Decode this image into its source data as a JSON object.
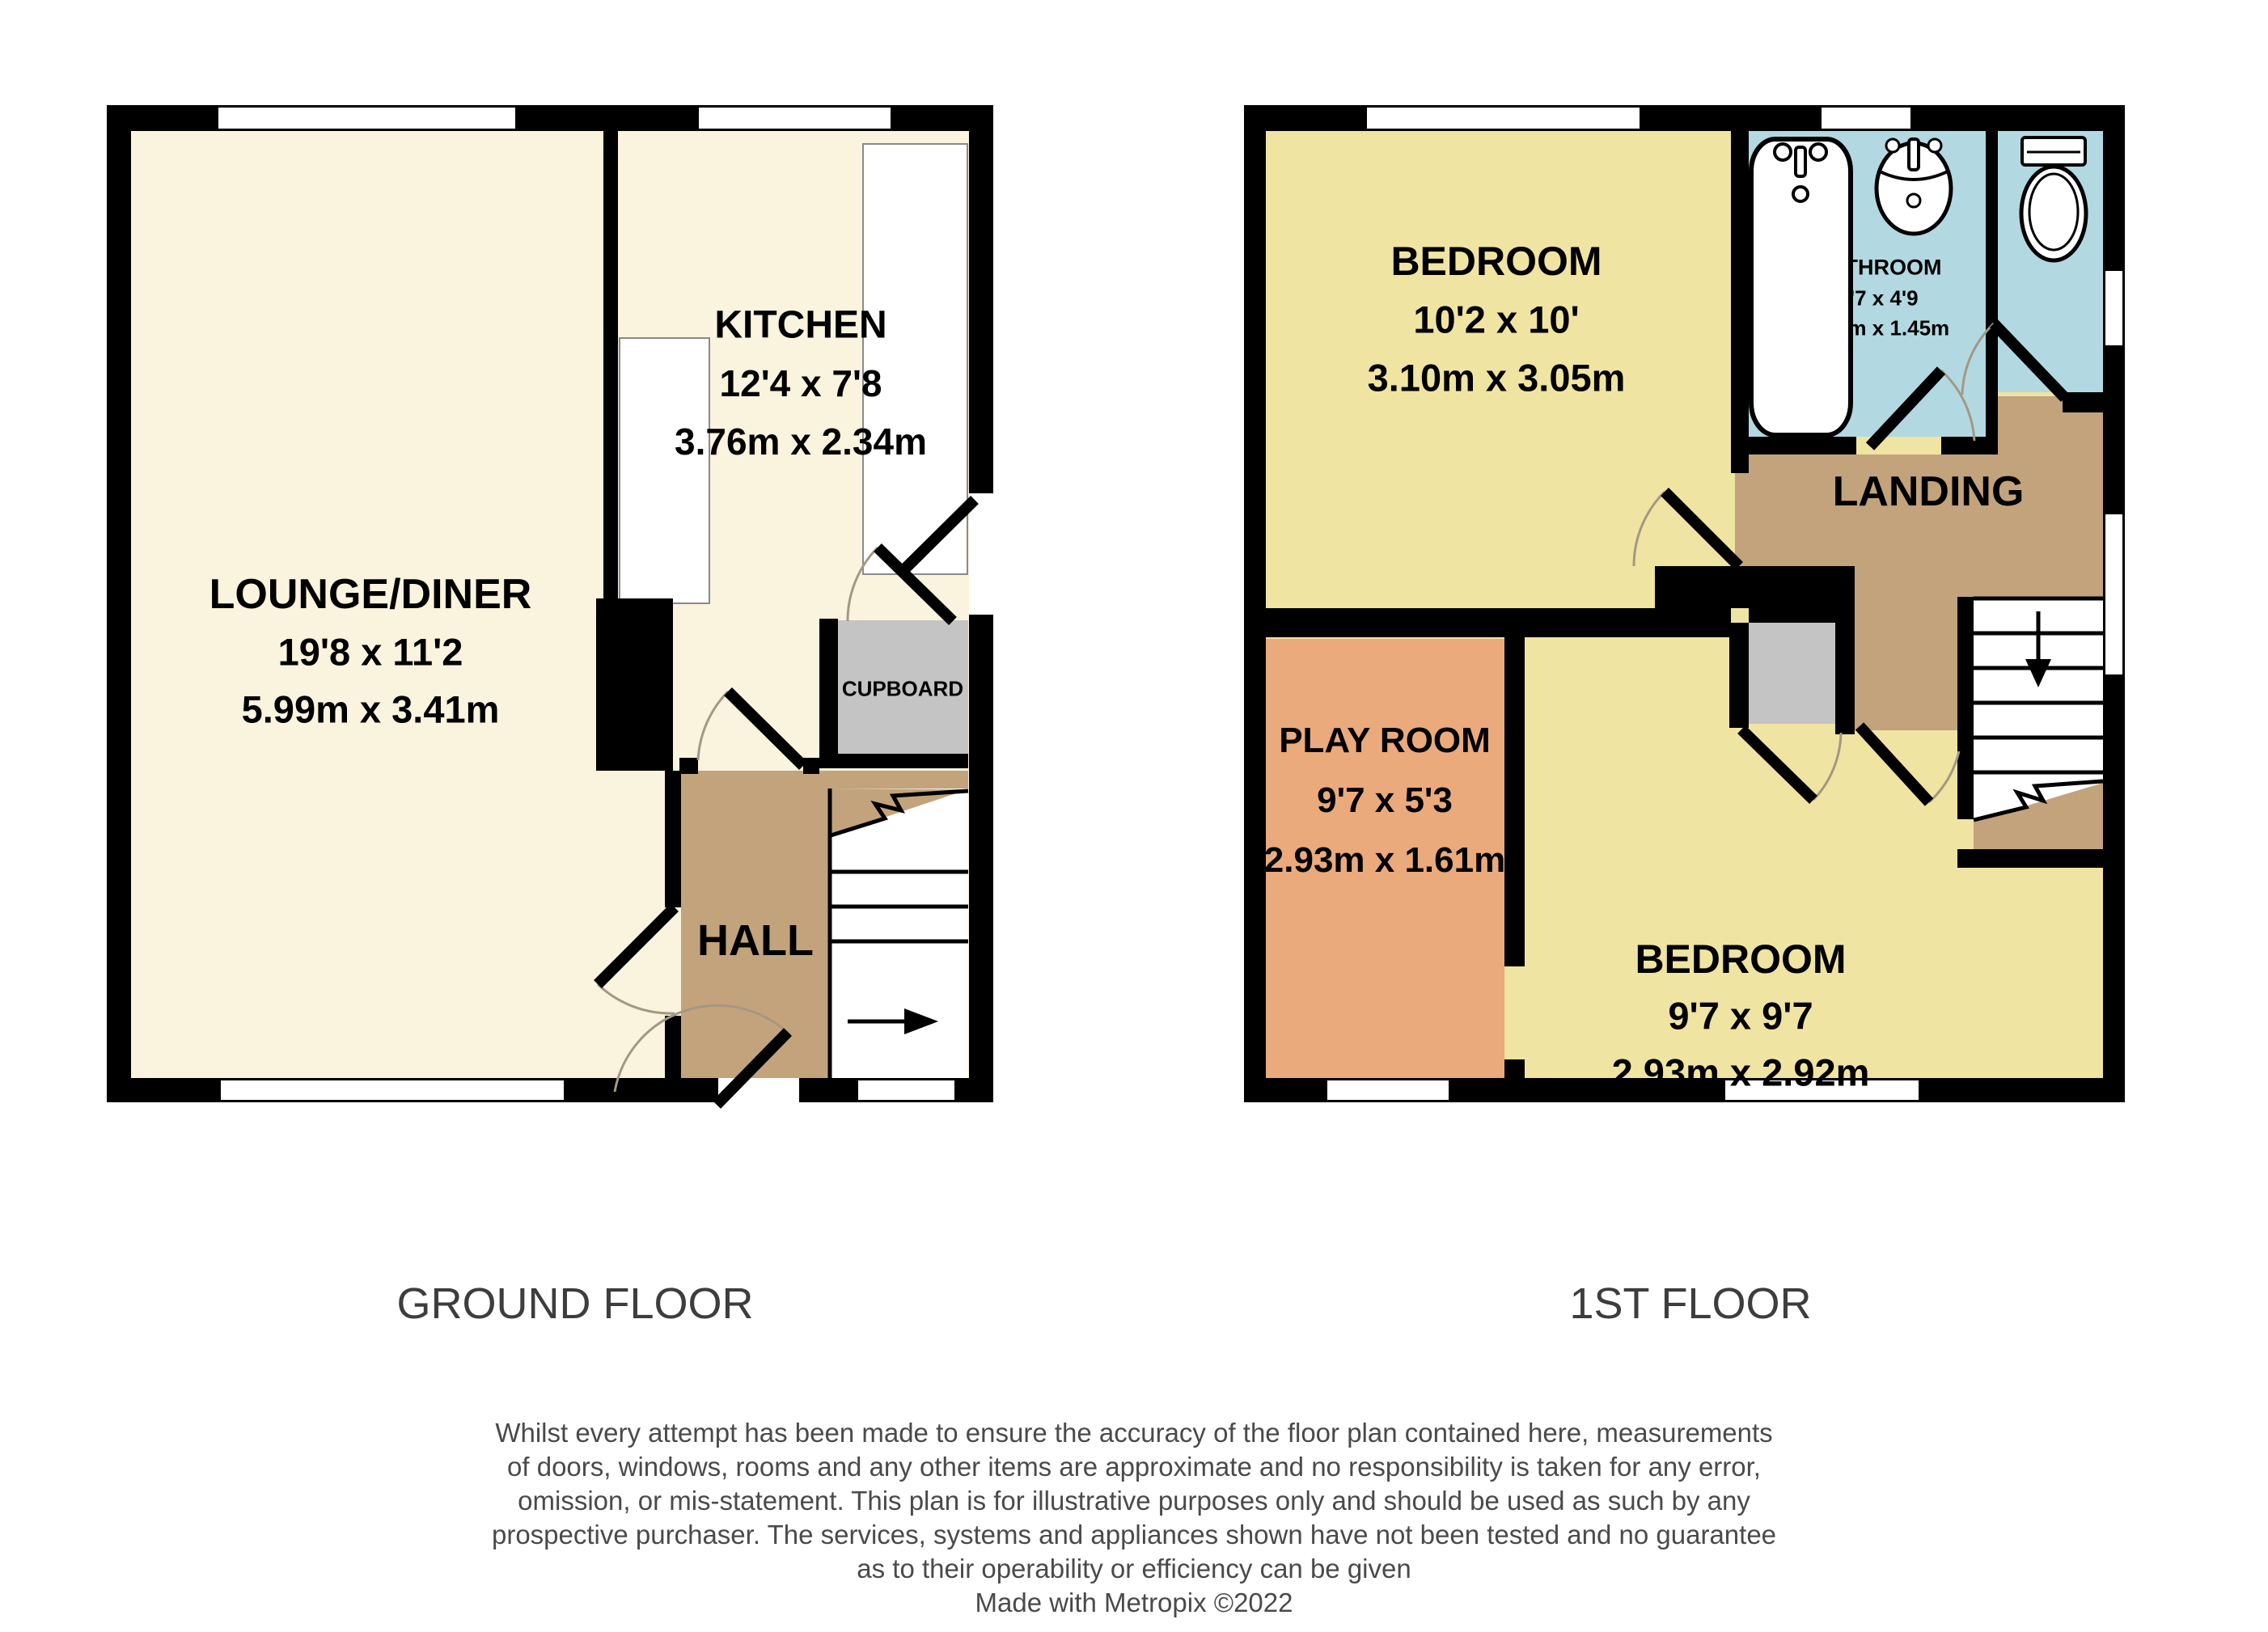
{
  "colors": {
    "wall": "#000000",
    "window": "#ffffff",
    "cream": "#FAF3DD",
    "tan": "#C3A37B",
    "yellow": "#EFE4A1",
    "orange": "#EAAA7C",
    "blue": "#B2D9E1",
    "gray": "#C4C4C4",
    "label": "#000000",
    "floor_label": "#3d3d3d",
    "disclaimer": "#4a4a4a",
    "arc": "#A39883"
  },
  "ground_floor": {
    "label": "GROUND FLOOR",
    "lounge": {
      "name": "LOUNGE/DINER",
      "imperial": "19'8 x 11'2",
      "metric": "5.99m x 3.41m"
    },
    "kitchen": {
      "name": "KITCHEN",
      "imperial": "12'4 x 7'8",
      "metric": "3.76m x 2.34m"
    },
    "hall": {
      "name": "HALL"
    },
    "cupboard": {
      "name": "CUPBOARD"
    }
  },
  "first_floor": {
    "label": "1ST FLOOR",
    "bedroom1": {
      "name": "BEDROOM",
      "imperial": "10'2 x 10'",
      "metric": "3.10m x 3.05m"
    },
    "bathroom": {
      "name": "BATHROOM",
      "imperial": "5'7 x 4'9",
      "metric": "1.70m x 1.45m"
    },
    "landing": {
      "name": "LANDING"
    },
    "playroom": {
      "name": "PLAY ROOM",
      "imperial": "9'7 x 5'3",
      "metric": "2.93m x 1.61m"
    },
    "bedroom2": {
      "name": "BEDROOM",
      "imperial": "9'7 x 9'7",
      "metric": "2.93m x 2.92m"
    }
  },
  "disclaimer": {
    "lines": [
      "Whilst every attempt has been made to ensure the accuracy of the floor plan contained here, measurements",
      "of doors, windows, rooms and any other items are approximate and no responsibility is taken for any error,",
      "omission, or mis-statement. This plan is for illustrative purposes only and should be used as such by any",
      "prospective purchaser. The services, systems and appliances shown have not been tested and no guarantee",
      "as to their operability or efficiency can be given",
      "Made with Metropix ©2022"
    ]
  }
}
